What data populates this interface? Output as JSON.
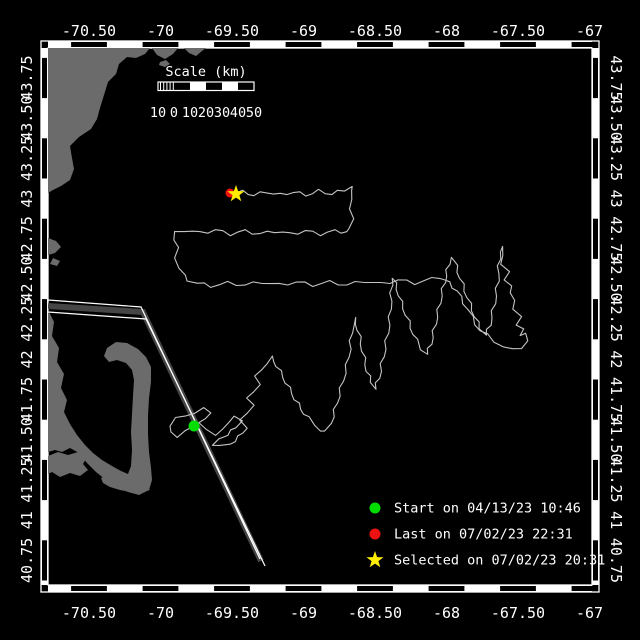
{
  "window": {
    "background": "#000000",
    "width": 640,
    "height": 640
  },
  "map_frame": {
    "frame_color": "#ffffff",
    "inner": {
      "x": 48,
      "y": 48,
      "w": 544,
      "h": 537
    },
    "outer": {
      "x": 41,
      "y": 41,
      "w": 558,
      "h": 551
    },
    "band_halfwidth_lon": 17.9,
    "band_halfwidth_lat": 20.1,
    "lon_ticks": [
      {
        "label": "-70.50",
        "x": 89
      },
      {
        "label": "-70",
        "x": 160.5
      },
      {
        "label": "-69.50",
        "x": 232
      },
      {
        "label": "-69",
        "x": 303.5
      },
      {
        "label": "-68.50",
        "x": 375
      },
      {
        "label": "-68",
        "x": 446.5
      },
      {
        "label": "-67.50",
        "x": 518
      },
      {
        "label": "-67",
        "x": 589.5
      }
    ],
    "lat_ticks": [
      {
        "label": "43.75",
        "y": 78
      },
      {
        "label": "43.50",
        "y": 118.2
      },
      {
        "label": "43.25",
        "y": 158.4
      },
      {
        "label": "43",
        "y": 198.6
      },
      {
        "label": "42.75",
        "y": 238.8
      },
      {
        "label": "42.50",
        "y": 279
      },
      {
        "label": "42.25",
        "y": 319.2
      },
      {
        "label": "42",
        "y": 359.4
      },
      {
        "label": "41.75",
        "y": 399.6
      },
      {
        "label": "41.50",
        "y": 439.8
      },
      {
        "label": "41.25",
        "y": 480
      },
      {
        "label": "41",
        "y": 520.2
      },
      {
        "label": "40.75",
        "y": 560.4
      }
    ]
  },
  "scale_bar": {
    "title": "Scale (km)",
    "title_x": 206,
    "title_y": 76,
    "x": 158,
    "y": 82,
    "width": 96,
    "height": 8.5,
    "segment_width": 16,
    "white_segments": [
      190,
      222
    ],
    "hatch_end": 174,
    "labels": [
      {
        "text": "10",
        "x": 158
      },
      {
        "text": "0",
        "x": 174
      },
      {
        "text": "10",
        "x": 190
      },
      {
        "text": "20",
        "x": 206
      },
      {
        "text": "30",
        "x": 222
      },
      {
        "text": "40",
        "x": 238
      },
      {
        "text": "50",
        "x": 254
      }
    ],
    "label_y": 117
  },
  "legend": {
    "marker_x": 375,
    "text_x": 394,
    "text_color": "#ffffff",
    "rows": [
      {
        "marker": "dot",
        "color": "#00dd00",
        "label": "Start on 04/13/23 10:46",
        "y": 508
      },
      {
        "marker": "dot",
        "color": "#ee1111",
        "label": "Last on 07/02/23 22:31",
        "y": 534
      },
      {
        "marker": "star",
        "color": "#ffee00",
        "label": "Selected on 07/02/23 20:31",
        "y": 560
      }
    ]
  },
  "geography": {
    "land_color": "#6b6b6b",
    "polygons": [
      {
        "name": "new-england-coast",
        "points": [
          [
            48,
            48
          ],
          [
            150,
            48
          ],
          [
            145,
            54
          ],
          [
            136,
            58
          ],
          [
            127,
            57
          ],
          [
            119,
            64
          ],
          [
            116,
            74
          ],
          [
            108,
            82
          ],
          [
            104,
            95
          ],
          [
            100,
            108
          ],
          [
            97,
            119
          ],
          [
            91,
            129
          ],
          [
            79,
            137
          ],
          [
            70,
            146
          ],
          [
            72,
            158
          ],
          [
            74,
            169
          ],
          [
            70,
            180
          ],
          [
            61,
            186
          ],
          [
            53,
            190
          ],
          [
            48,
            193
          ]
        ]
      },
      {
        "name": "cape-ann-1",
        "points": [
          [
            152,
            48
          ],
          [
            157,
            55
          ],
          [
            165,
            59
          ],
          [
            173,
            54
          ],
          [
            178,
            48
          ]
        ]
      },
      {
        "name": "cape-ann-2",
        "points": [
          [
            184,
            48
          ],
          [
            189,
            53
          ],
          [
            196,
            56
          ],
          [
            202,
            51
          ],
          [
            206,
            48
          ]
        ]
      },
      {
        "name": "coast-islet",
        "points": [
          [
            160,
            62
          ],
          [
            166,
            60
          ],
          [
            170,
            64
          ],
          [
            165,
            67
          ],
          [
            159,
            65
          ]
        ]
      },
      {
        "name": "boston-islands-1",
        "points": [
          [
            48,
            238
          ],
          [
            56,
            241
          ],
          [
            61,
            247
          ],
          [
            55,
            253
          ],
          [
            48,
            255
          ]
        ]
      },
      {
        "name": "boston-islands-2",
        "points": [
          [
            53,
            258
          ],
          [
            60,
            261
          ],
          [
            57,
            266
          ],
          [
            50,
            264
          ]
        ]
      },
      {
        "name": "mainland-and-cape-cod",
        "points": [
          [
            48,
            310
          ],
          [
            54,
            322
          ],
          [
            52,
            336
          ],
          [
            59,
            348
          ],
          [
            57,
            362
          ],
          [
            64,
            374
          ],
          [
            61,
            388
          ],
          [
            67,
            400
          ],
          [
            64,
            412
          ],
          [
            70,
            424
          ],
          [
            77,
            435
          ],
          [
            85,
            445
          ],
          [
            93,
            453
          ],
          [
            102,
            460
          ],
          [
            112,
            466
          ],
          [
            121,
            471
          ],
          [
            128,
            474
          ],
          [
            131,
            466
          ],
          [
            132,
            450
          ],
          [
            131,
            432
          ],
          [
            132,
            414
          ],
          [
            133,
            396
          ],
          [
            134,
            380
          ],
          [
            132,
            370
          ],
          [
            126,
            363
          ],
          [
            117,
            360
          ],
          [
            109,
            362
          ],
          [
            104,
            356
          ],
          [
            107,
            348
          ],
          [
            116,
            342
          ],
          [
            127,
            343
          ],
          [
            138,
            349
          ],
          [
            146,
            357
          ],
          [
            151,
            367
          ],
          [
            151,
            382
          ],
          [
            149,
            398
          ],
          [
            148,
            416
          ],
          [
            148,
            434
          ],
          [
            149,
            452
          ],
          [
            151,
            468
          ],
          [
            152,
            480
          ],
          [
            149,
            490
          ],
          [
            139,
            495
          ],
          [
            128,
            492
          ],
          [
            117,
            487
          ],
          [
            106,
            480
          ],
          [
            96,
            472
          ],
          [
            87,
            463
          ],
          [
            79,
            453
          ],
          [
            70,
            448
          ],
          [
            62,
            452
          ],
          [
            55,
            450
          ],
          [
            48,
            452
          ]
        ]
      },
      {
        "name": "marthas-vineyard",
        "points": [
          [
            48,
            456
          ],
          [
            58,
            452
          ],
          [
            68,
            455
          ],
          [
            78,
            452
          ],
          [
            87,
            457
          ],
          [
            83,
            464
          ],
          [
            88,
            470
          ],
          [
            80,
            476
          ],
          [
            70,
            473
          ],
          [
            60,
            477
          ],
          [
            52,
            472
          ],
          [
            48,
            474
          ]
        ]
      },
      {
        "name": "nantucket",
        "points": [
          [
            101,
            478
          ],
          [
            110,
            474
          ],
          [
            118,
            477
          ],
          [
            128,
            480
          ],
          [
            138,
            483
          ],
          [
            147,
            486
          ],
          [
            150,
            490
          ],
          [
            142,
            492
          ],
          [
            131,
            492
          ],
          [
            120,
            490
          ],
          [
            110,
            487
          ],
          [
            103,
            483
          ]
        ]
      }
    ]
  },
  "shipping_lane": {
    "edge_color": "#ffffff",
    "band_color": "#454545",
    "band_width": 6,
    "line_a": [
      [
        48,
        300
      ],
      [
        141,
        307
      ],
      [
        260,
        559
      ]
    ],
    "line_b": [
      [
        48,
        312
      ],
      [
        146,
        319
      ],
      [
        265,
        566
      ]
    ],
    "band": [
      [
        48,
        306
      ],
      [
        143,
        312
      ],
      [
        261,
        561
      ]
    ]
  },
  "track": {
    "color": "#c4c4c4",
    "wiggle_amp": 1.8,
    "wiggle_step": 7,
    "points": [
      [
        194,
        426
      ],
      [
        186,
        432
      ],
      [
        178,
        436
      ],
      [
        171,
        432
      ],
      [
        169,
        425
      ],
      [
        176,
        419
      ],
      [
        185,
        416
      ],
      [
        194,
        412
      ],
      [
        203,
        409
      ],
      [
        211,
        413
      ],
      [
        206,
        420
      ],
      [
        198,
        424
      ],
      [
        206,
        429
      ],
      [
        215,
        434
      ],
      [
        224,
        430
      ],
      [
        229,
        422
      ],
      [
        235,
        415
      ],
      [
        241,
        420
      ],
      [
        236,
        428
      ],
      [
        227,
        434
      ],
      [
        219,
        439
      ],
      [
        213,
        444
      ],
      [
        220,
        447
      ],
      [
        230,
        444
      ],
      [
        239,
        437
      ],
      [
        246,
        429
      ],
      [
        241,
        421
      ],
      [
        247,
        413
      ],
      [
        253,
        406
      ],
      [
        248,
        399
      ],
      [
        253,
        392
      ],
      [
        259,
        385
      ],
      [
        256,
        377
      ],
      [
        261,
        370
      ],
      [
        266,
        363
      ],
      [
        271,
        357
      ],
      [
        277,
        366
      ],
      [
        283,
        377
      ],
      [
        289,
        388
      ],
      [
        295,
        399
      ],
      [
        301,
        409
      ],
      [
        308,
        418
      ],
      [
        315,
        425
      ],
      [
        321,
        430
      ],
      [
        326,
        432
      ],
      [
        331,
        423
      ],
      [
        335,
        410
      ],
      [
        339,
        396
      ],
      [
        343,
        381
      ],
      [
        347,
        365
      ],
      [
        350,
        349
      ],
      [
        352,
        333
      ],
      [
        354,
        318
      ],
      [
        358,
        330
      ],
      [
        361,
        344
      ],
      [
        364,
        358
      ],
      [
        367,
        371
      ],
      [
        371,
        382
      ],
      [
        375,
        389
      ],
      [
        379,
        378
      ],
      [
        382,
        364
      ],
      [
        385,
        349
      ],
      [
        388,
        333
      ],
      [
        390,
        317
      ],
      [
        391,
        301
      ],
      [
        392,
        285
      ],
      [
        393,
        278
      ],
      [
        397,
        289
      ],
      [
        401,
        302
      ],
      [
        406,
        315
      ],
      [
        411,
        328
      ],
      [
        416,
        340
      ],
      [
        421,
        349
      ],
      [
        427,
        354
      ],
      [
        431,
        344
      ],
      [
        434,
        331
      ],
      [
        437,
        317
      ],
      [
        440,
        303
      ],
      [
        443,
        289
      ],
      [
        446,
        276
      ],
      [
        449,
        264
      ],
      [
        452,
        257
      ],
      [
        456,
        266
      ],
      [
        460,
        278
      ],
      [
        465,
        291
      ],
      [
        470,
        304
      ],
      [
        475,
        317
      ],
      [
        480,
        328
      ],
      [
        486,
        335
      ],
      [
        490,
        325
      ],
      [
        493,
        311
      ],
      [
        496,
        296
      ],
      [
        498,
        281
      ],
      [
        499,
        266
      ],
      [
        500,
        252
      ],
      [
        501,
        247
      ],
      [
        504,
        256
      ],
      [
        501,
        264
      ],
      [
        508,
        271
      ],
      [
        505,
        279
      ],
      [
        512,
        286
      ],
      [
        509,
        294
      ],
      [
        516,
        301
      ],
      [
        513,
        309
      ],
      [
        520,
        316
      ],
      [
        517,
        324
      ],
      [
        524,
        329
      ],
      [
        521,
        337
      ],
      [
        527,
        333
      ],
      [
        528,
        341
      ],
      [
        521,
        347
      ],
      [
        512,
        350
      ],
      [
        503,
        347
      ],
      [
        495,
        341
      ],
      [
        487,
        335
      ],
      [
        480,
        331
      ],
      [
        472,
        317
      ],
      [
        464,
        303
      ],
      [
        457,
        291
      ],
      [
        449,
        283
      ],
      [
        440,
        277
      ],
      [
        432,
        279
      ],
      [
        415,
        283
      ],
      [
        398,
        280
      ],
      [
        381,
        284
      ],
      [
        364,
        281
      ],
      [
        347,
        285
      ],
      [
        330,
        282
      ],
      [
        313,
        285
      ],
      [
        296,
        282
      ],
      [
        279,
        285
      ],
      [
        262,
        282
      ],
      [
        245,
        285
      ],
      [
        228,
        283
      ],
      [
        211,
        286
      ],
      [
        197,
        283
      ],
      [
        188,
        280
      ],
      [
        184,
        276
      ],
      [
        179,
        268
      ],
      [
        176,
        258
      ],
      [
        177,
        248
      ],
      [
        174,
        240
      ],
      [
        175,
        233
      ],
      [
        185,
        230
      ],
      [
        200,
        233
      ],
      [
        215,
        230
      ],
      [
        230,
        234
      ],
      [
        245,
        231
      ],
      [
        260,
        234
      ],
      [
        275,
        231
      ],
      [
        290,
        234
      ],
      [
        305,
        231
      ],
      [
        320,
        234
      ],
      [
        335,
        231
      ],
      [
        347,
        232
      ],
      [
        350,
        229
      ],
      [
        352,
        219
      ],
      [
        350,
        209
      ],
      [
        353,
        199
      ],
      [
        350,
        190
      ],
      [
        352,
        186
      ],
      [
        344,
        190
      ],
      [
        332,
        194
      ],
      [
        319,
        191
      ],
      [
        306,
        195
      ],
      [
        293,
        192
      ],
      [
        280,
        195
      ],
      [
        267,
        192
      ],
      [
        254,
        195
      ],
      [
        243,
        192
      ],
      [
        236,
        193
      ]
    ]
  },
  "markers": {
    "start": {
      "x": 194,
      "y": 426,
      "r": 5.5,
      "color": "#00dd00"
    },
    "last": {
      "x": 230,
      "y": 193,
      "r": 4.5,
      "color": "#ee1111"
    },
    "selected": {
      "x": 236,
      "y": 194,
      "r_outer": 9,
      "r_inner": 3.6,
      "color": "#ffee00"
    }
  }
}
